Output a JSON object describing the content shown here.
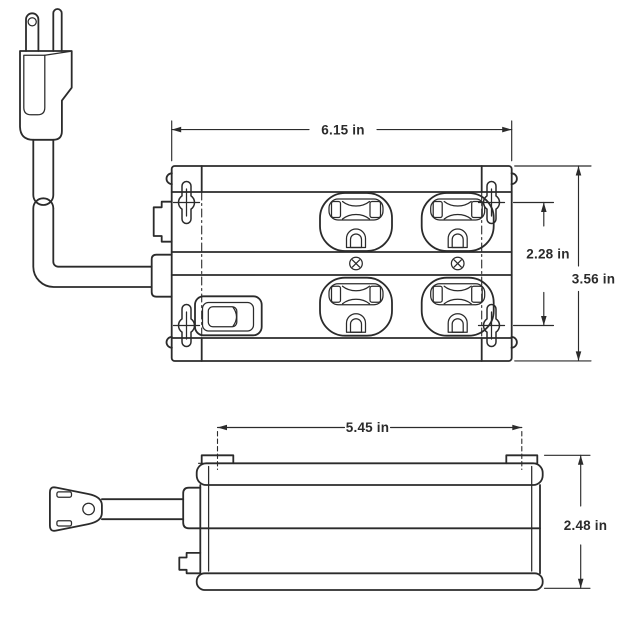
{
  "page": {
    "background_color": "#ffffff"
  },
  "drawing": {
    "stroke_color": "#2b2b2b",
    "top_view": {
      "width_label": "6.15 in",
      "mount_slot_span_label": "2.28 in",
      "depth_label": "3.56 in"
    },
    "side_view": {
      "mount_tab_span_label": "5.45 in",
      "height_label": "2.48 in"
    }
  }
}
